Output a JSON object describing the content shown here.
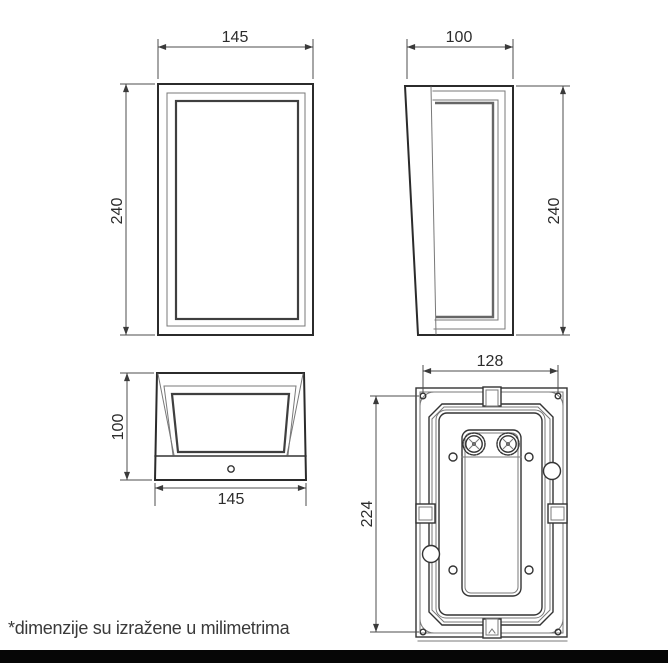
{
  "footnote": "*dimenzije su izražene u milimetrima",
  "views": {
    "front": {
      "width": "145",
      "height": "240"
    },
    "side": {
      "depth": "100",
      "height": "240"
    },
    "top": {
      "depth": "100",
      "width": "145"
    },
    "back": {
      "hole_spacing_width": "128",
      "hole_spacing_height": "224"
    }
  },
  "colors": {
    "outline": "#333333",
    "dimension_lines": "#4c4c4c",
    "dimension_text": "#2c2c2c",
    "footnote_text": "#3a3a3a",
    "bottom_bar": "#060606",
    "background": "#ffffff"
  }
}
